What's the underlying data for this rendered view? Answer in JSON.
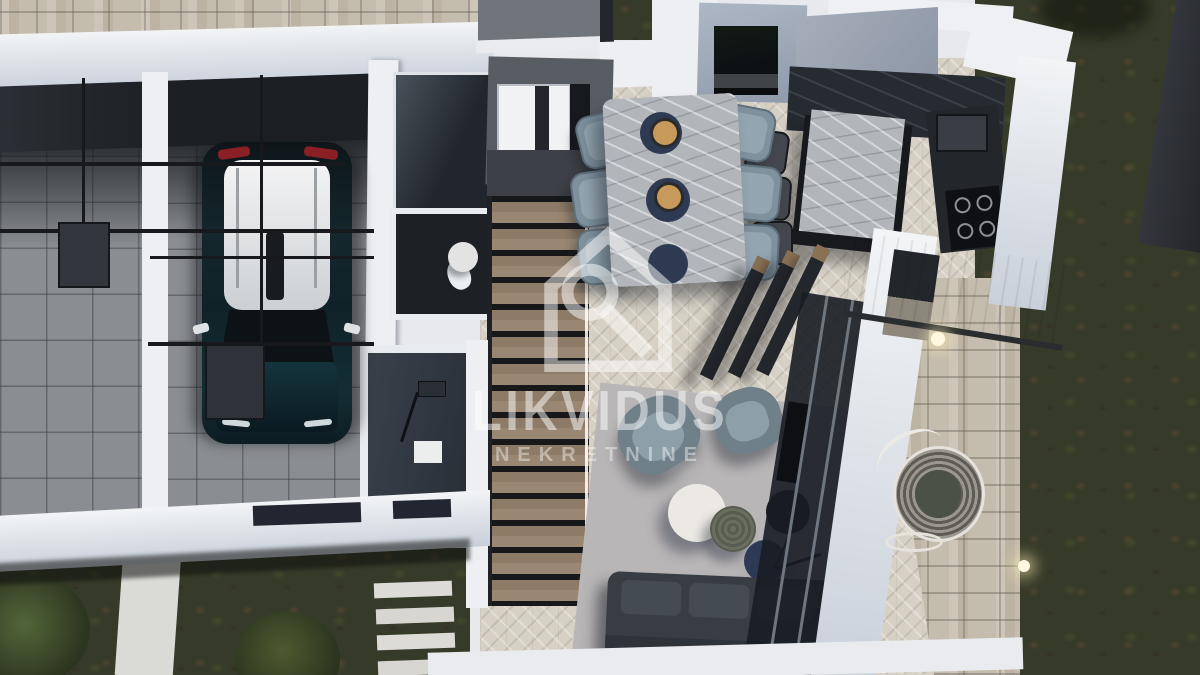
{
  "watermark": {
    "brand": "LIKVIDUS",
    "subtitle": "NEKRETNINE",
    "logo": "house-magnifier-icon"
  },
  "palette": {
    "wall_white": "#edeff2",
    "roof_dark": "#1c1f24",
    "garage_floor": "#8a8d92",
    "herringbone": "#d7d1c5",
    "wood_stair": "#8d7a67",
    "grass": "#363a28",
    "pavers": "#c4bcac",
    "marble_light": "#b2b6bb",
    "counter_dark": "#262a31",
    "chair_blue": "#7e919d",
    "sofa_dark": "#383d44",
    "rug": "#b9b6b7",
    "car_body": "#13272c",
    "car_roof": "#eef0f1",
    "taillight_red": "#8a2026",
    "exterior_wall_blue": "#9fa9b8"
  },
  "scene": {
    "type": "3d-floorplan-render",
    "rooms": [
      "carport",
      "garage",
      "hallway",
      "wc",
      "shower-room",
      "staircase",
      "dining-area",
      "kitchen",
      "living-room",
      "terrace",
      "garden"
    ]
  }
}
